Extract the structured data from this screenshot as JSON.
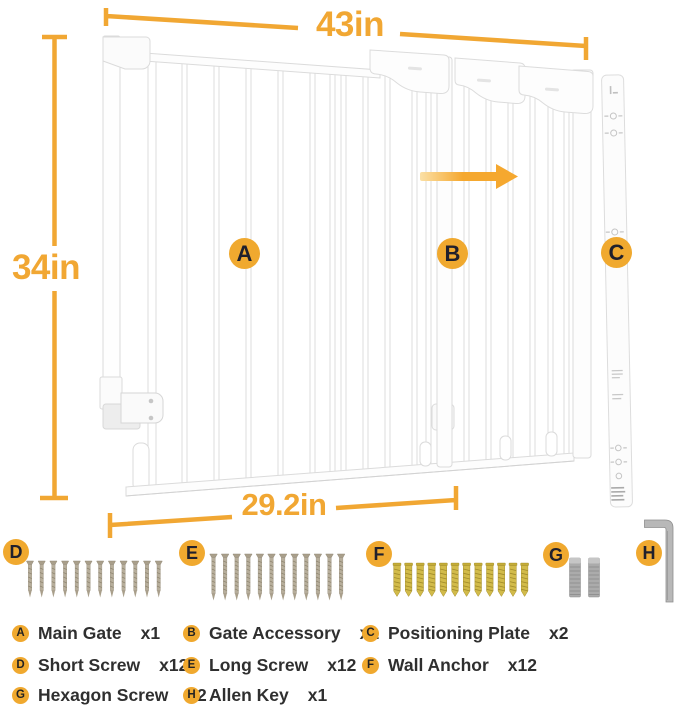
{
  "dimensions": {
    "top": "43in",
    "left": "34in",
    "bottom": "29.2in"
  },
  "markers": {
    "main_gate": "A",
    "gate_accessory": "B",
    "positioning_plate": "C",
    "short_screw": "D",
    "long_screw": "E",
    "wall_anchor": "F",
    "hexagon_screw": "G",
    "allen_key": "H"
  },
  "diagram": {
    "arrow_direction": "right",
    "displayed_item_counts": {
      "short_screws": 12,
      "long_screws": 12,
      "wall_anchors": 12,
      "hexagon_screws": 2,
      "allen_keys": 1
    }
  },
  "legend": {
    "items": [
      {
        "letter": "A",
        "name": "Main Gate",
        "count": "x1"
      },
      {
        "letter": "B",
        "name": "Gate Accessory",
        "count": "x1"
      },
      {
        "letter": "C",
        "name": "Positioning Plate",
        "count": "x2"
      },
      {
        "letter": "D",
        "name": "Short Screw",
        "count": "x12"
      },
      {
        "letter": "E",
        "name": "Long Screw",
        "count": "x12"
      },
      {
        "letter": "F",
        "name": "Wall Anchor",
        "count": "x12"
      },
      {
        "letter": "G",
        "name": "Hexagon Screw",
        "count": "x2"
      },
      {
        "letter": "H",
        "name": "Allen Key",
        "count": "x1"
      }
    ]
  },
  "colors": {
    "accent": "#F1A733",
    "marker_bg": "#F0A92F",
    "marker_text": "#20202C",
    "legend_text": "#2F2F2F",
    "screw_metal": "#B7AE9B",
    "anchor_yellow": "#D2BB4A",
    "hex_metal": "#ABABAB",
    "gate_outline": "#DDDDDD"
  }
}
